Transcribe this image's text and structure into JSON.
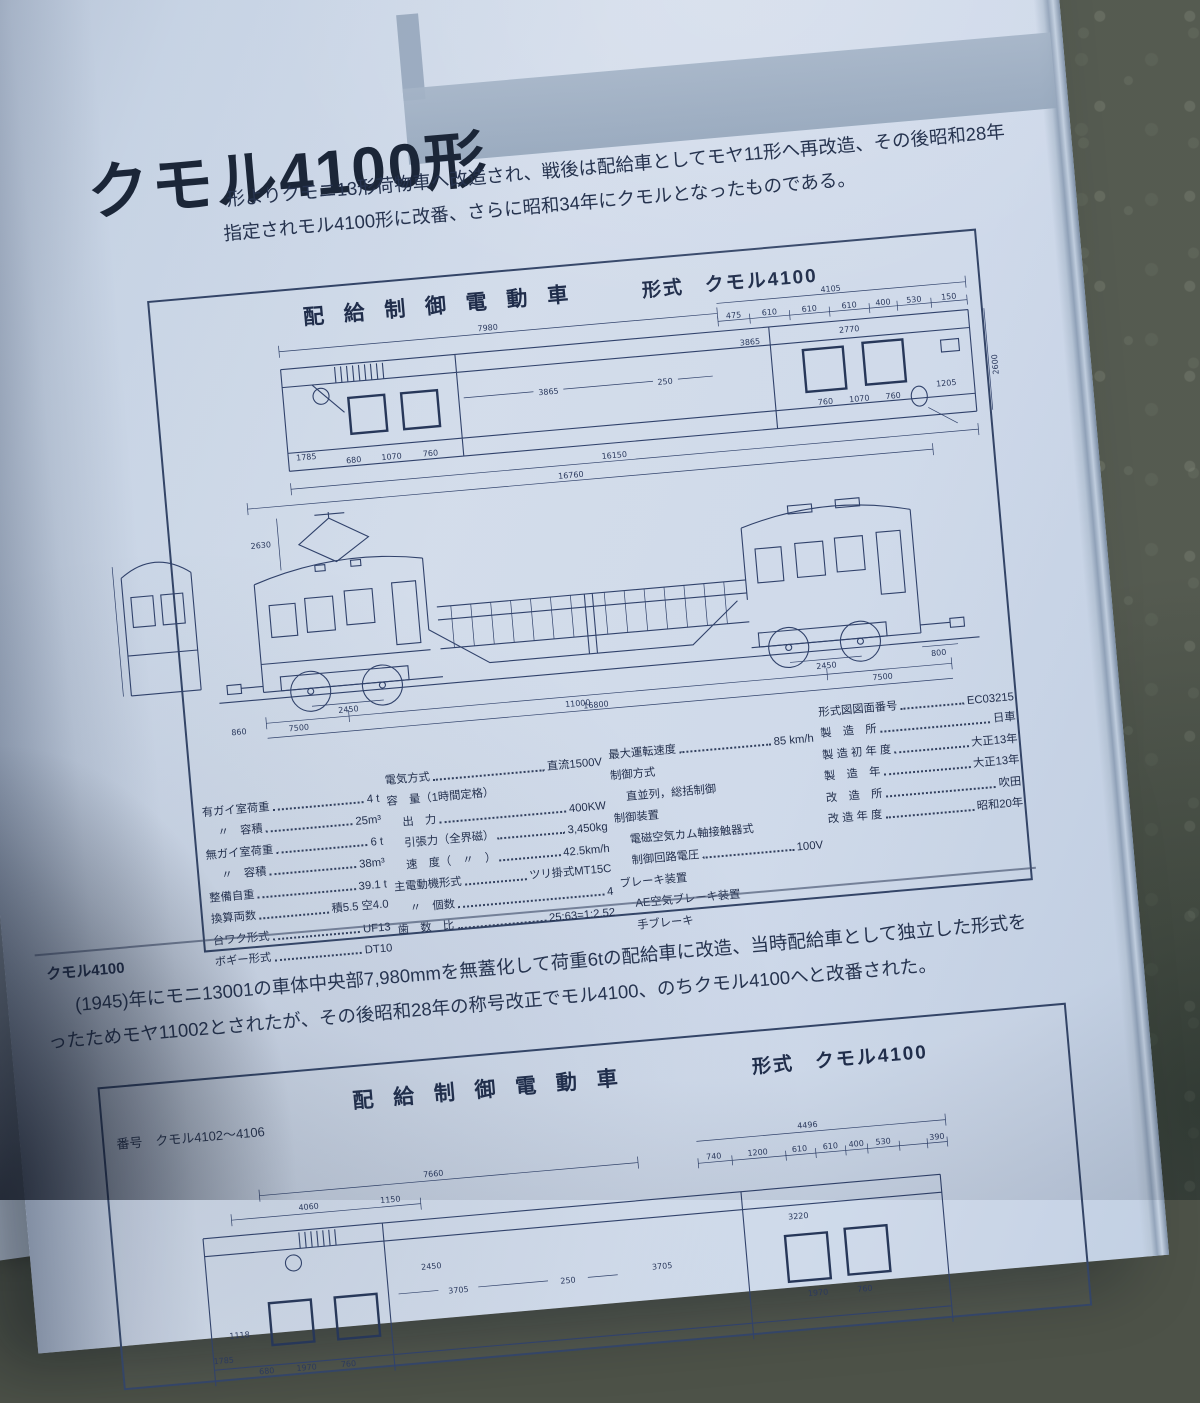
{
  "colors": {
    "ink": "#25324e",
    "page": "#d3deec",
    "fabric": "#575c50",
    "banner": "#9fafc2"
  },
  "left_page": {
    "fragment1": "たものである。",
    "fragment2": "る。"
  },
  "page": {
    "title": "クモル4100形",
    "intro_line1": "形よりクモニ13形荷物車へ改造され、戦後は配給車としてモヤ11形へ再改造、その後昭和28年",
    "intro_line2": "指定されモル4100形に改番、さらに昭和34年にクモルとなったものである。"
  },
  "diagram1": {
    "heading": "配 給 制 御 電 動 車",
    "type_label": "形式　クモル4100",
    "plan_labels": [
      "7980",
      "4105",
      "475",
      "610",
      "610",
      "610",
      "400",
      "530",
      "150",
      "3865",
      "250",
      "3865",
      "2770",
      "760",
      "1070",
      "760",
      "1205",
      "1785",
      "680",
      "1070",
      "760",
      "16150",
      "2600"
    ],
    "side_labels": [
      "16760",
      "2630",
      "2450",
      "2450",
      "800",
      "7500",
      "11000",
      "7500",
      "16800",
      "860"
    ]
  },
  "specs": {
    "col1": [
      {
        "label": "有ガイ室荷重",
        "value": "4 t"
      },
      {
        "label": "〃　容積",
        "value": "25m³",
        "indent": 1
      },
      {
        "label": "無ガイ室荷重",
        "value": "6 t"
      },
      {
        "label": "〃　容積",
        "value": "38m³",
        "indent": 1
      },
      {
        "label": "整備自重",
        "value": "39.1 t"
      },
      {
        "label": "換算両数",
        "value": "積5.5 空4.0"
      },
      {
        "label": "台ワク形式",
        "value": "UF13"
      },
      {
        "label": "ボギー形式",
        "value": "DT10"
      }
    ],
    "col2": [
      {
        "label": "電気方式",
        "value": "直流1500V"
      },
      {
        "label": "容　量（1時間定格）",
        "value": ""
      },
      {
        "label": "出　力",
        "value": "400KW",
        "indent": 1
      },
      {
        "label": "引張力（全界磁）",
        "value": "3,450kg",
        "indent": 1
      },
      {
        "label": "速　度（　〃　）",
        "value": "42.5km/h",
        "indent": 1
      },
      {
        "label": "主電動機形式",
        "value": "ツリ掛式MT15C"
      },
      {
        "label": "〃　個数",
        "value": "4",
        "indent": 1
      },
      {
        "label": "歯　数　比",
        "value": "25:63=1:2.52"
      }
    ],
    "col3": [
      {
        "label": "最大運転速度",
        "value": "85 km/h"
      },
      {
        "label": "制御方式",
        "value": ""
      },
      {
        "label": "直並列，総括制御",
        "value": "",
        "indent": 1
      },
      {
        "label": "制御装置",
        "value": ""
      },
      {
        "label": "電磁空気カム軸接触器式",
        "value": "",
        "indent": 1
      },
      {
        "label": "制御回路電圧",
        "value": "100V",
        "indent": 1
      },
      {
        "label": "ブレーキ装置",
        "value": ""
      },
      {
        "label": "AE空気ブレーキ装置",
        "value": "",
        "indent": 1
      },
      {
        "label": "手ブレーキ",
        "value": "",
        "indent": 1
      }
    ],
    "col4": [
      {
        "label": "形式図図面番号",
        "value": "EC03215"
      },
      {
        "label": "製　造　所",
        "value": "日車"
      },
      {
        "label": "製 造 初 年 度",
        "value": "大正13年"
      },
      {
        "label": "製　造　年",
        "value": "大正13年"
      },
      {
        "label": "改　造　所",
        "value": "吹田"
      },
      {
        "label": "改 造 年 度",
        "value": "昭和20年"
      }
    ]
  },
  "section2": {
    "label": "クモル4100",
    "body_line1": "(1945)年にモニ13001の車体中央部7,980mmを無蓋化して荷重6tの配給車に改造、当時配給車として独立した形式を",
    "body_line2": "ったためモヤ11002とされたが、その後昭和28年の称号改正でモル4100、のちクモル4100へと改番された。"
  },
  "diagram2": {
    "heading": "配 給 制 御 電 動 車",
    "type_label": "形式　クモル4100",
    "number_label": "番号　クモル4102〜4106",
    "plan_labels": [
      "7660",
      "4496",
      "740",
      "1200",
      "610",
      "610",
      "400",
      "530",
      "390",
      "3705",
      "250",
      "3705",
      "3220",
      "1970",
      "760",
      "4060",
      "1150",
      "1785",
      "680",
      "1970",
      "760",
      "2450",
      "1118"
    ]
  }
}
